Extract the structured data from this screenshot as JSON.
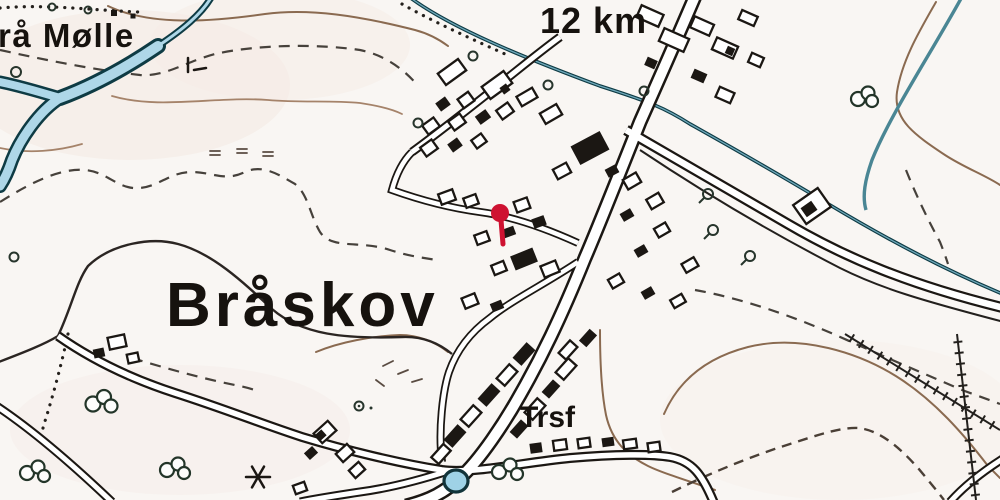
{
  "map": {
    "labels": {
      "raa_moelle": "rå Mølle",
      "distance": "12 km",
      "town": "Bråskov",
      "transformer": "Trsf"
    },
    "marker": {
      "name": "red-location-pin",
      "map_x": 500,
      "map_y": 215
    },
    "colors": {
      "background": "#f9f6f3",
      "road_black": "#1b1713",
      "water_light": "#aed7e8",
      "water_dark": "#0e3b44",
      "contour_brown": "#8a6a50",
      "contour_dash_gray": "#46413b",
      "marker_red": "#ce1231",
      "vegetation_green": "#233529"
    },
    "features": [
      "river",
      "stream",
      "pond",
      "major-road",
      "village-streets",
      "buildings",
      "contour-lines",
      "power-lines",
      "bushes",
      "trees",
      "windmill-star"
    ]
  }
}
